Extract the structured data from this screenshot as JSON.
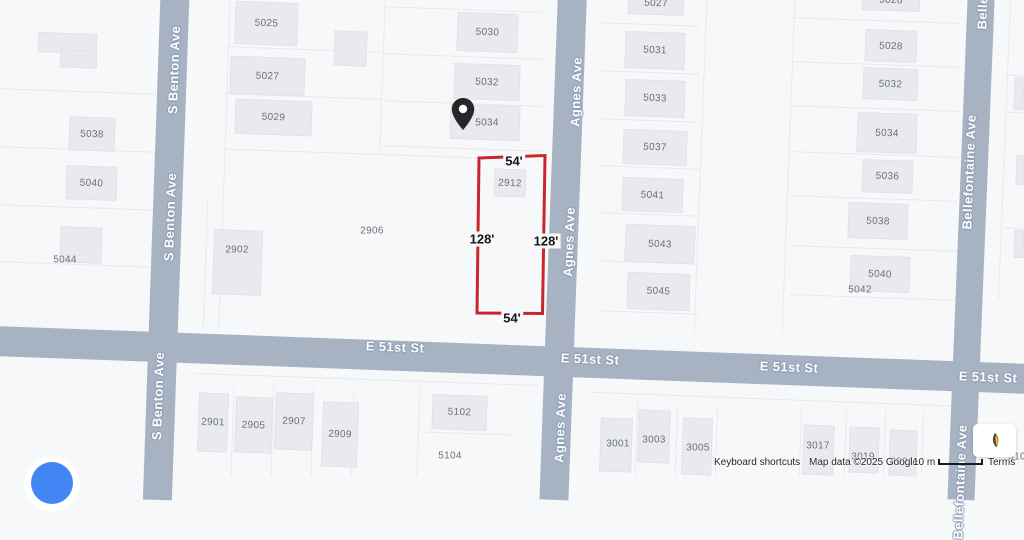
{
  "map": {
    "streets": {
      "benton": {
        "name": "S Benton Ave"
      },
      "agnes": {
        "name": "Agnes Ave"
      },
      "bellefontaine": {
        "name": "Bellefontaine Ave"
      },
      "e51": {
        "name": "E 51st St"
      }
    },
    "parcel_outline": {
      "color": "#c9262c",
      "top_label": "54'",
      "bottom_label": "54'",
      "left_label": "128'",
      "right_label": "128'"
    },
    "pin_building": "5034",
    "buildings": [
      {
        "n": "",
        "x": 38,
        "y": 33,
        "w": 59,
        "h": 20
      },
      {
        "n": "",
        "x": 60,
        "y": 50,
        "w": 37,
        "h": 18
      },
      {
        "n": "5038",
        "x": 69,
        "y": 117,
        "w": 46,
        "h": 34
      },
      {
        "n": "5040",
        "x": 66,
        "y": 166,
        "w": 51,
        "h": 34
      },
      {
        "n": "",
        "x": 60,
        "y": 227,
        "w": 42,
        "h": 36
      },
      {
        "n": "5025",
        "x": 235,
        "y": 2,
        "w": 63,
        "h": 43
      },
      {
        "n": "",
        "x": 334,
        "y": 31,
        "w": 33,
        "h": 35
      },
      {
        "n": "5027",
        "x": 230,
        "y": 57,
        "w": 75,
        "h": 38
      },
      {
        "n": "5029",
        "x": 235,
        "y": 100,
        "w": 77,
        "h": 35
      },
      {
        "n": "5030",
        "x": 457,
        "y": 13,
        "w": 61,
        "h": 39
      },
      {
        "n": "5032",
        "x": 454,
        "y": 64,
        "w": 66,
        "h": 36
      },
      {
        "n": "5034",
        "x": 450,
        "y": 105,
        "w": 70,
        "h": 35,
        "lx": 487,
        "ly": 123
      },
      {
        "n": "2902",
        "x": 213,
        "y": 230,
        "w": 49,
        "h": 65,
        "lx": 237,
        "ly": 250
      },
      {
        "n": "2912",
        "x": 494,
        "y": 169,
        "w": 32,
        "h": 28
      },
      {
        "n": "5027",
        "x": 628,
        "y": -8,
        "w": 56,
        "h": 23
      },
      {
        "n": "5031",
        "x": 625,
        "y": 32,
        "w": 60,
        "h": 37
      },
      {
        "n": "5033",
        "x": 625,
        "y": 80,
        "w": 60,
        "h": 37
      },
      {
        "n": "5037",
        "x": 623,
        "y": 130,
        "w": 64,
        "h": 35
      },
      {
        "n": "5041",
        "x": 622,
        "y": 178,
        "w": 61,
        "h": 34
      },
      {
        "n": "5043",
        "x": 625,
        "y": 225,
        "w": 70,
        "h": 38
      },
      {
        "n": "5045",
        "x": 627,
        "y": 273,
        "w": 63,
        "h": 37
      },
      {
        "n": "5026",
        "x": 862,
        "y": -10,
        "w": 58,
        "h": 21
      },
      {
        "n": "5028",
        "x": 865,
        "y": 30,
        "w": 52,
        "h": 32
      },
      {
        "n": "5032",
        "x": 863,
        "y": 68,
        "w": 55,
        "h": 32
      },
      {
        "n": "5034",
        "x": 857,
        "y": 113,
        "w": 60,
        "h": 40
      },
      {
        "n": "5036",
        "x": 862,
        "y": 160,
        "w": 51,
        "h": 33
      },
      {
        "n": "5038",
        "x": 848,
        "y": 203,
        "w": 60,
        "h": 36
      },
      {
        "n": "5040",
        "x": 850,
        "y": 256,
        "w": 60,
        "h": 36
      },
      {
        "n": "2901",
        "x": 198,
        "y": 393,
        "w": 30,
        "h": 59
      },
      {
        "n": "2905",
        "x": 235,
        "y": 397,
        "w": 37,
        "h": 56
      },
      {
        "n": "2907",
        "x": 275,
        "y": 393,
        "w": 38,
        "h": 57
      },
      {
        "n": "2909",
        "x": 322,
        "y": 402,
        "w": 36,
        "h": 65
      },
      {
        "n": "5102",
        "x": 432,
        "y": 395,
        "w": 55,
        "h": 35
      },
      {
        "n": "3001",
        "x": 600,
        "y": 418,
        "w": 32,
        "h": 54,
        "lx": 618,
        "ly": 444
      },
      {
        "n": "3003",
        "x": 638,
        "y": 410,
        "w": 32,
        "h": 53,
        "lx": 654,
        "ly": 440
      },
      {
        "n": "3005",
        "x": 682,
        "y": 418,
        "w": 30,
        "h": 57,
        "lx": 698,
        "ly": 448
      },
      {
        "n": "3017",
        "x": 803,
        "y": 425,
        "w": 31,
        "h": 50,
        "lx": 818,
        "ly": 446
      },
      {
        "n": "3019",
        "x": 849,
        "y": 427,
        "w": 30,
        "h": 46,
        "lx": 863,
        "ly": 457
      },
      {
        "n": "3021",
        "x": 889,
        "y": 430,
        "w": 28,
        "h": 46,
        "lx": 902,
        "ly": 462
      },
      {
        "n": "",
        "x": 1014,
        "y": 77,
        "w": 10,
        "h": 33
      },
      {
        "n": "",
        "x": 1016,
        "y": 155,
        "w": 8,
        "h": 30
      },
      {
        "n": "",
        "x": 1014,
        "y": 230,
        "w": 10,
        "h": 28
      }
    ],
    "lot_labels": [
      {
        "n": "5044",
        "x": 65,
        "y": 260
      },
      {
        "n": "2906",
        "x": 372,
        "y": 231
      },
      {
        "n": "5042",
        "x": 860,
        "y": 290
      },
      {
        "n": "5104",
        "x": 450,
        "y": 456
      },
      {
        "n": "3101",
        "x": 1020,
        "y": 457
      }
    ]
  },
  "attribution": {
    "keyboard_shortcuts": "Keyboard shortcuts",
    "map_data": "Map data ©2025 Google",
    "scale_text": "10 m",
    "terms": "Terms"
  },
  "colors": {
    "street": "#a7b3c3",
    "parcel_outline": "#c9262c",
    "google_blue": "#4285f4"
  }
}
